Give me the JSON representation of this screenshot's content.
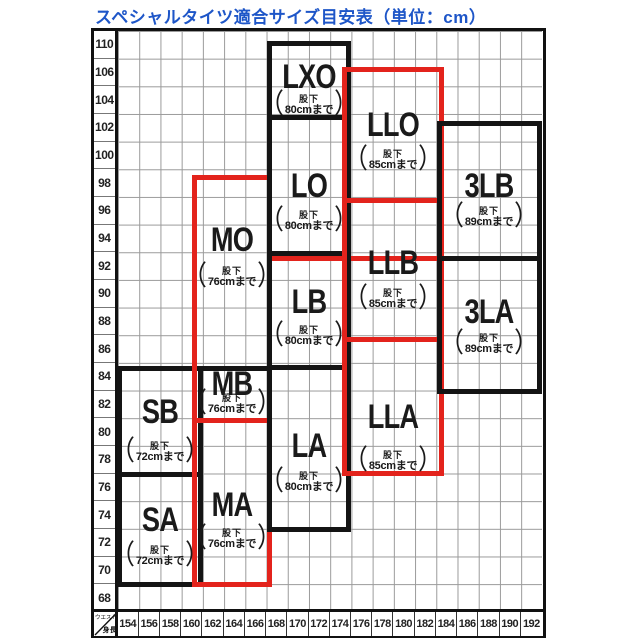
{
  "title": "スペシャルタイツ適合サイズ目安表（単位：cm）",
  "colors": {
    "title_blue": "#1e56c8",
    "box_red": "#e3231c",
    "box_black": "#141414"
  },
  "punctuation": {
    "paren_open": "（",
    "paren_close": "）"
  },
  "chart_data": {
    "type": "table",
    "title": "スペシャルタイツ適合サイズ目安表",
    "unit": "cm",
    "x_axis": {
      "label": "身長",
      "ticks": [
        154,
        156,
        158,
        160,
        162,
        164,
        166,
        168,
        170,
        172,
        174,
        176,
        178,
        180,
        182,
        184,
        186,
        188,
        190,
        192
      ]
    },
    "y_axis": {
      "label": "ウエスト",
      "ticks": [
        110,
        106,
        104,
        102,
        100,
        98,
        96,
        94,
        92,
        90,
        88,
        86,
        84,
        82,
        80,
        78,
        76,
        74,
        72,
        70,
        68
      ]
    },
    "sizes": [
      {
        "name": "SA",
        "border": "black",
        "leg_label": "股下",
        "leg_value": "72cmまで",
        "height_range": [
          154,
          160
        ],
        "waist_range": [
          68,
          76
        ]
      },
      {
        "name": "SB",
        "border": "black",
        "leg_label": "股下",
        "leg_value": "72cmまで",
        "height_range": [
          154,
          160
        ],
        "waist_range": [
          76,
          84
        ]
      },
      {
        "name": "MA",
        "border": "red",
        "leg_label": "股下",
        "leg_value": "76cmまで",
        "height_range": [
          160,
          168
        ],
        "waist_range": [
          68,
          80
        ]
      },
      {
        "name": "MB",
        "border": "red",
        "leg_label": "股下",
        "leg_value": "76cmまで",
        "height_range": [
          160,
          168
        ],
        "waist_range": [
          80,
          84
        ]
      },
      {
        "name": "MO",
        "border": "red",
        "leg_label": "股下",
        "leg_value": "76cmまで",
        "height_range": [
          160,
          168
        ],
        "waist_range": [
          84,
          98
        ]
      },
      {
        "name": "LA",
        "border": "black",
        "leg_label": "股下",
        "leg_value": "80cmまで",
        "height_range": [
          168,
          174
        ],
        "waist_range": [
          72,
          84
        ]
      },
      {
        "name": "LB",
        "border": "black",
        "leg_label": "股下",
        "leg_value": "80cmまで",
        "height_range": [
          168,
          174
        ],
        "waist_range": [
          84,
          92
        ]
      },
      {
        "name": "LO",
        "border": "black",
        "leg_label": "股下",
        "leg_value": "80cmまで",
        "height_range": [
          168,
          174
        ],
        "waist_range": [
          92,
          102
        ]
      },
      {
        "name": "LXO",
        "border": "black",
        "leg_label": "股下",
        "leg_value": "80cmまで",
        "height_range": [
          168,
          174
        ],
        "waist_range": [
          102,
          108
        ]
      },
      {
        "name": "LLA",
        "border": "red",
        "leg_label": "股下",
        "leg_value": "85cmまで",
        "height_range": [
          174,
          184
        ],
        "waist_range": [
          76,
          86
        ]
      },
      {
        "name": "LLB",
        "border": "red",
        "leg_label": "股下",
        "leg_value": "85cmまで",
        "height_range": [
          174,
          184
        ],
        "waist_range": [
          86,
          96
        ]
      },
      {
        "name": "LLO",
        "border": "red",
        "leg_label": "股下",
        "leg_value": "85cmまで",
        "height_range": [
          174,
          184
        ],
        "waist_range": [
          96,
          106
        ]
      },
      {
        "name": "3LA",
        "border": "black",
        "leg_label": "股下",
        "leg_value": "89cmまで",
        "height_range": [
          184,
          192
        ],
        "waist_range": [
          86,
          94
        ]
      },
      {
        "name": "3LB",
        "border": "black",
        "leg_label": "股下",
        "leg_value": "89cmまで",
        "height_range": [
          184,
          192
        ],
        "waist_range": [
          94,
          102
        ]
      }
    ]
  }
}
